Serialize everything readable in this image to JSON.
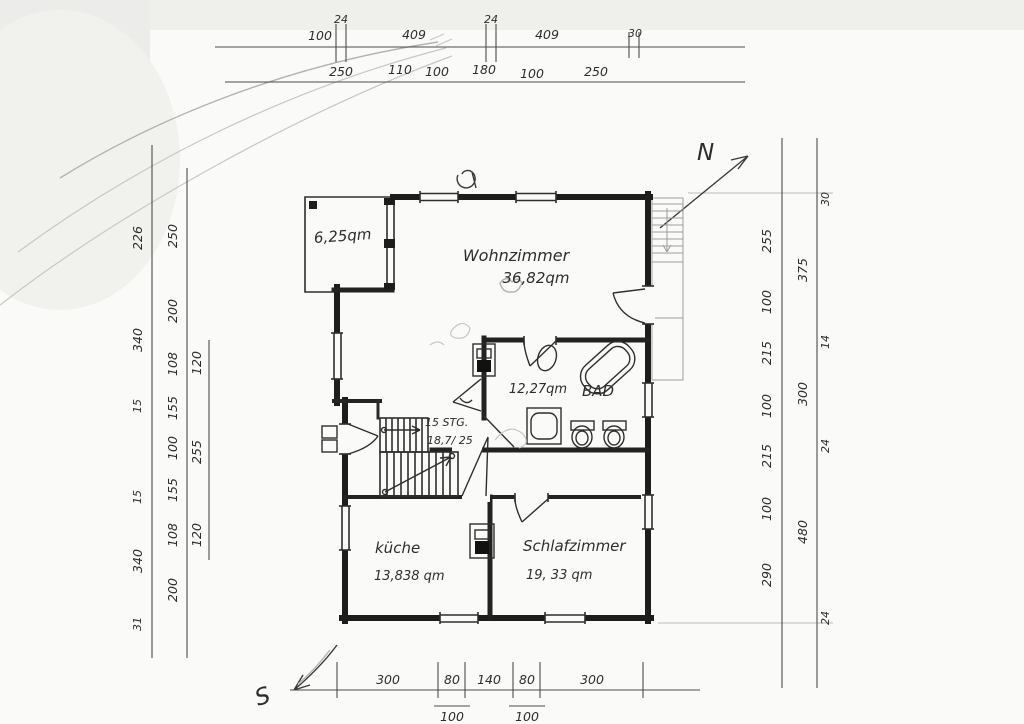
{
  "compass": {
    "north": "N",
    "south": "S"
  },
  "rooms": {
    "balcony_area": "6,25qm",
    "living_name": "Wohnzimmer",
    "living_area": "36,82qm",
    "bath_area": "12,27qm",
    "bath_name": "BAD",
    "stairs_line1": "15 STG.",
    "stairs_line2": "18,7/ 25",
    "kitchen_name": "küche",
    "kitchen_area": "13,838 qm",
    "bedroom_name": "Schlafzimmer",
    "bedroom_area": "19, 33 qm"
  },
  "dims": {
    "top_outer": [
      "100",
      "24",
      "409",
      "24",
      "409",
      "30"
    ],
    "top_inner": [
      "250",
      "110",
      "100",
      "180",
      "100",
      "250"
    ],
    "left_outer": [
      "226",
      "340",
      "15",
      "15",
      "340",
      "31"
    ],
    "left_inner": [
      "250",
      "200",
      "108",
      "155",
      "100",
      "155",
      "108",
      "200"
    ],
    "left_third": [
      "120",
      "255",
      "120"
    ],
    "right_inner": [
      "255",
      "100",
      "215",
      "100",
      "215",
      "100",
      "290"
    ],
    "right_outer": [
      "30",
      "375",
      "14",
      "300",
      "24",
      "480",
      "24"
    ],
    "bottom": [
      "300",
      "80",
      "140",
      "80",
      "300"
    ],
    "bottom_sub": [
      "100",
      "100"
    ]
  }
}
